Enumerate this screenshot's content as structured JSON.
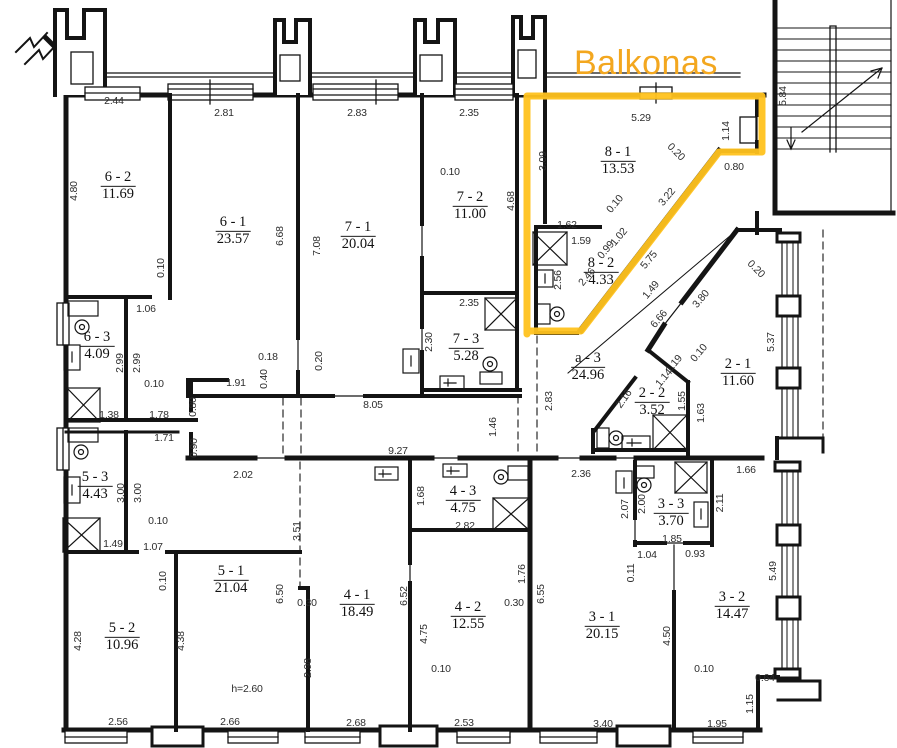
{
  "balcony": {
    "label": "Balkonas",
    "text_color": "#F3A71F",
    "outline_color": "#FFC21E"
  },
  "plan": {
    "rooms": [
      {
        "id": "6 - 2",
        "area": "11.69",
        "x": 118,
        "y": 185
      },
      {
        "id": "6 - 1",
        "area": "23.57",
        "x": 233,
        "y": 230
      },
      {
        "id": "7 - 1",
        "area": "20.04",
        "x": 358,
        "y": 235
      },
      {
        "id": "7 - 2",
        "area": "11.00",
        "x": 470,
        "y": 205
      },
      {
        "id": "7 - 3",
        "area": "5.28",
        "x": 466,
        "y": 347
      },
      {
        "id": "8 - 1",
        "area": "13.53",
        "x": 618,
        "y": 160
      },
      {
        "id": "8 - 2",
        "area": "4.33",
        "x": 601,
        "y": 271
      },
      {
        "id": "a - 3",
        "area": "24.96",
        "x": 588,
        "y": 366
      },
      {
        "id": "2 - 1",
        "area": "11.60",
        "x": 738,
        "y": 372
      },
      {
        "id": "2 - 2",
        "area": "3.52",
        "x": 652,
        "y": 401
      },
      {
        "id": "6 - 3",
        "area": "4.09",
        "x": 97,
        "y": 345
      },
      {
        "id": "5 - 3",
        "area": "4.43",
        "x": 95,
        "y": 485
      },
      {
        "id": "5 - 2",
        "area": "10.96",
        "x": 122,
        "y": 636
      },
      {
        "id": "5 - 1",
        "area": "21.04",
        "x": 231,
        "y": 579
      },
      {
        "id": "4 - 1",
        "area": "18.49",
        "x": 357,
        "y": 603
      },
      {
        "id": "4 - 3",
        "area": "4.75",
        "x": 463,
        "y": 499
      },
      {
        "id": "4 - 2",
        "area": "12.55",
        "x": 468,
        "y": 615
      },
      {
        "id": "3 - 1",
        "area": "20.15",
        "x": 602,
        "y": 625
      },
      {
        "id": "3 - 3",
        "area": "3.70",
        "x": 671,
        "y": 512
      },
      {
        "id": "3 - 2",
        "area": "14.47",
        "x": 732,
        "y": 605
      }
    ],
    "dims": [
      {
        "t": "2.44",
        "x": 114,
        "y": 101
      },
      {
        "t": "2.81",
        "x": 224,
        "y": 113
      },
      {
        "t": "2.83",
        "x": 357,
        "y": 113
      },
      {
        "t": "2.35",
        "x": 469,
        "y": 113
      },
      {
        "t": "5.29",
        "x": 641,
        "y": 118
      },
      {
        "t": "1.14",
        "x": 726,
        "y": 131,
        "r": -90
      },
      {
        "t": "4.80",
        "x": 74,
        "y": 191,
        "r": -90
      },
      {
        "t": "6.68",
        "x": 280,
        "y": 236,
        "r": -90
      },
      {
        "t": "7.08",
        "x": 317,
        "y": 246,
        "r": -90
      },
      {
        "t": "4.68",
        "x": 511,
        "y": 201,
        "r": -90
      },
      {
        "t": "0.10",
        "x": 450,
        "y": 172
      },
      {
        "t": "0.10",
        "x": 161,
        "y": 268,
        "r": -90
      },
      {
        "t": "1.06",
        "x": 146,
        "y": 309
      },
      {
        "t": "3.09",
        "x": 543,
        "y": 161,
        "r": -90
      },
      {
        "t": "0.20",
        "x": 676,
        "y": 152,
        "r": 45
      },
      {
        "t": "0.80",
        "x": 734,
        "y": 167
      },
      {
        "t": "3.22",
        "x": 667,
        "y": 197,
        "r": -50
      },
      {
        "t": "1.62",
        "x": 567,
        "y": 225
      },
      {
        "t": "1.59",
        "x": 581,
        "y": 241
      },
      {
        "t": "0.10",
        "x": 615,
        "y": 204,
        "r": -50
      },
      {
        "t": "1.02",
        "x": 619,
        "y": 237,
        "r": -50
      },
      {
        "t": "0.99",
        "x": 606,
        "y": 250,
        "r": -50
      },
      {
        "t": "5.75",
        "x": 649,
        "y": 260,
        "r": -50
      },
      {
        "t": "2.56",
        "x": 558,
        "y": 280,
        "r": -90
      },
      {
        "t": "2.46",
        "x": 587,
        "y": 277,
        "r": -50
      },
      {
        "t": "1.49",
        "x": 651,
        "y": 290,
        "r": -50
      },
      {
        "t": "6.66",
        "x": 659,
        "y": 319,
        "r": -50
      },
      {
        "t": "3.80",
        "x": 701,
        "y": 299,
        "r": -50
      },
      {
        "t": "0.20",
        "x": 756,
        "y": 269,
        "r": 45
      },
      {
        "t": "5.84",
        "x": 783,
        "y": 96,
        "r": -90
      },
      {
        "t": "2.35",
        "x": 469,
        "y": 303
      },
      {
        "t": "2.30",
        "x": 429,
        "y": 342,
        "r": -90
      },
      {
        "t": "0.18",
        "x": 268,
        "y": 357
      },
      {
        "t": "0.40",
        "x": 264,
        "y": 379,
        "r": -90
      },
      {
        "t": "1.91",
        "x": 236,
        "y": 383
      },
      {
        "t": "0.20",
        "x": 319,
        "y": 361,
        "r": -90
      },
      {
        "t": "8.05",
        "x": 373,
        "y": 405
      },
      {
        "t": "0.80",
        "x": 193,
        "y": 407,
        "r": -90
      },
      {
        "t": "0.90",
        "x": 194,
        "y": 448,
        "r": -90
      },
      {
        "t": "2.02",
        "x": 243,
        "y": 475
      },
      {
        "t": "9.27",
        "x": 398,
        "y": 451
      },
      {
        "t": "1.46",
        "x": 493,
        "y": 427,
        "r": -90
      },
      {
        "t": "2.83",
        "x": 549,
        "y": 401,
        "r": -90
      },
      {
        "t": "1.19",
        "x": 674,
        "y": 364,
        "r": -50
      },
      {
        "t": "0.10",
        "x": 699,
        "y": 353,
        "r": -50
      },
      {
        "t": "1.14",
        "x": 664,
        "y": 378,
        "r": -50
      },
      {
        "t": "2.16",
        "x": 624,
        "y": 399,
        "r": -55
      },
      {
        "t": "1.55",
        "x": 682,
        "y": 401,
        "r": -90
      },
      {
        "t": "1.63",
        "x": 701,
        "y": 413,
        "r": -90
      },
      {
        "t": "5.37",
        "x": 771,
        "y": 342,
        "r": -90
      },
      {
        "t": "2.99",
        "x": 120,
        "y": 363,
        "r": -90
      },
      {
        "t": "2.99",
        "x": 137,
        "y": 363,
        "r": -90
      },
      {
        "t": "0.10",
        "x": 154,
        "y": 384
      },
      {
        "t": "1.38",
        "x": 109,
        "y": 415
      },
      {
        "t": "1.78",
        "x": 159,
        "y": 415
      },
      {
        "t": "1.71",
        "x": 164,
        "y": 438
      },
      {
        "t": "3.00",
        "x": 121,
        "y": 493,
        "r": -90
      },
      {
        "t": "3.00",
        "x": 138,
        "y": 493,
        "r": -90
      },
      {
        "t": "0.10",
        "x": 158,
        "y": 521
      },
      {
        "t": "1.49",
        "x": 113,
        "y": 544
      },
      {
        "t": "1.07",
        "x": 153,
        "y": 547
      },
      {
        "t": "0.10",
        "x": 163,
        "y": 581,
        "r": -90
      },
      {
        "t": "4.28",
        "x": 78,
        "y": 641,
        "r": -90
      },
      {
        "t": "4.38",
        "x": 181,
        "y": 641,
        "r": -90
      },
      {
        "t": "2.56",
        "x": 118,
        "y": 722
      },
      {
        "t": "3.51",
        "x": 297,
        "y": 531,
        "r": -90
      },
      {
        "t": "6.50",
        "x": 280,
        "y": 594,
        "r": -90
      },
      {
        "t": "h=2.60",
        "x": 247,
        "y": 689
      },
      {
        "t": "2.66",
        "x": 230,
        "y": 722
      },
      {
        "t": "0.30",
        "x": 307,
        "y": 603
      },
      {
        "t": "2.98",
        "x": 308,
        "y": 668,
        "r": -90
      },
      {
        "t": "2.68",
        "x": 356,
        "y": 723
      },
      {
        "t": "6.52",
        "x": 404,
        "y": 596,
        "r": -90
      },
      {
        "t": "4.75",
        "x": 424,
        "y": 634,
        "r": -90
      },
      {
        "t": "0.10",
        "x": 441,
        "y": 669
      },
      {
        "t": "1.68",
        "x": 421,
        "y": 496,
        "r": -90
      },
      {
        "t": "2.82",
        "x": 465,
        "y": 526
      },
      {
        "t": "1.76",
        "x": 522,
        "y": 574,
        "r": -90
      },
      {
        "t": "0.30",
        "x": 514,
        "y": 603
      },
      {
        "t": "2.53",
        "x": 464,
        "y": 723
      },
      {
        "t": "2.36",
        "x": 581,
        "y": 474
      },
      {
        "t": "6.55",
        "x": 541,
        "y": 594,
        "r": -90
      },
      {
        "t": "3.40",
        "x": 603,
        "y": 724
      },
      {
        "t": "0.11",
        "x": 631,
        "y": 573,
        "r": -90
      },
      {
        "t": "1.04",
        "x": 647,
        "y": 555
      },
      {
        "t": "0.93",
        "x": 695,
        "y": 554
      },
      {
        "t": "2.07",
        "x": 625,
        "y": 509,
        "r": -90
      },
      {
        "t": "2.00",
        "x": 642,
        "y": 504,
        "r": -90
      },
      {
        "t": "1.85",
        "x": 672,
        "y": 539
      },
      {
        "t": "2.11",
        "x": 720,
        "y": 503,
        "r": -90
      },
      {
        "t": "1.66",
        "x": 746,
        "y": 470
      },
      {
        "t": "4.50",
        "x": 667,
        "y": 636,
        "r": -90
      },
      {
        "t": "0.10",
        "x": 704,
        "y": 669
      },
      {
        "t": "5.49",
        "x": 773,
        "y": 571,
        "r": -90
      },
      {
        "t": "0.64",
        "x": 765,
        "y": 678
      },
      {
        "t": "1.15",
        "x": 750,
        "y": 704,
        "r": -90
      },
      {
        "t": "1.95",
        "x": 717,
        "y": 724
      }
    ]
  }
}
